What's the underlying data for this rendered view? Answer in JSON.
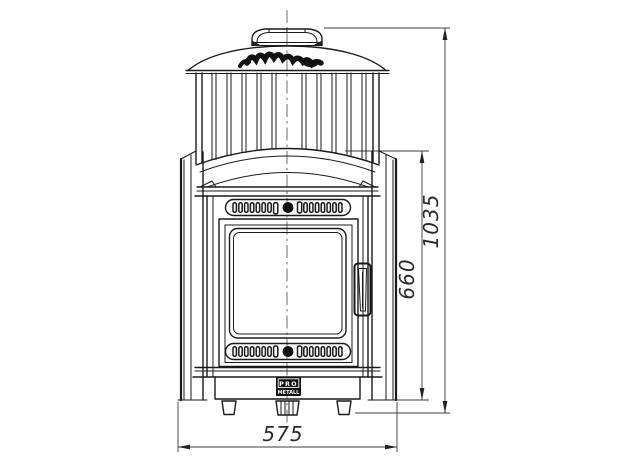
{
  "drawing": {
    "type": "technical-drawing",
    "subject": "sauna-stove-front-view",
    "dimension_labels": {
      "overall_height_mm": "1035",
      "firebox_section_height_mm": "660",
      "overall_width_mm": "575"
    },
    "brand_badge": {
      "line1": "PRO",
      "line2": "METALL"
    },
    "icons": {
      "brand_script_logo": "cursive-brand-signature",
      "vent_knob": "round-damper-knob"
    },
    "colors": {
      "line": "#1a1a1a",
      "dimension": "#3c3c3c",
      "background": "#ffffff"
    }
  }
}
